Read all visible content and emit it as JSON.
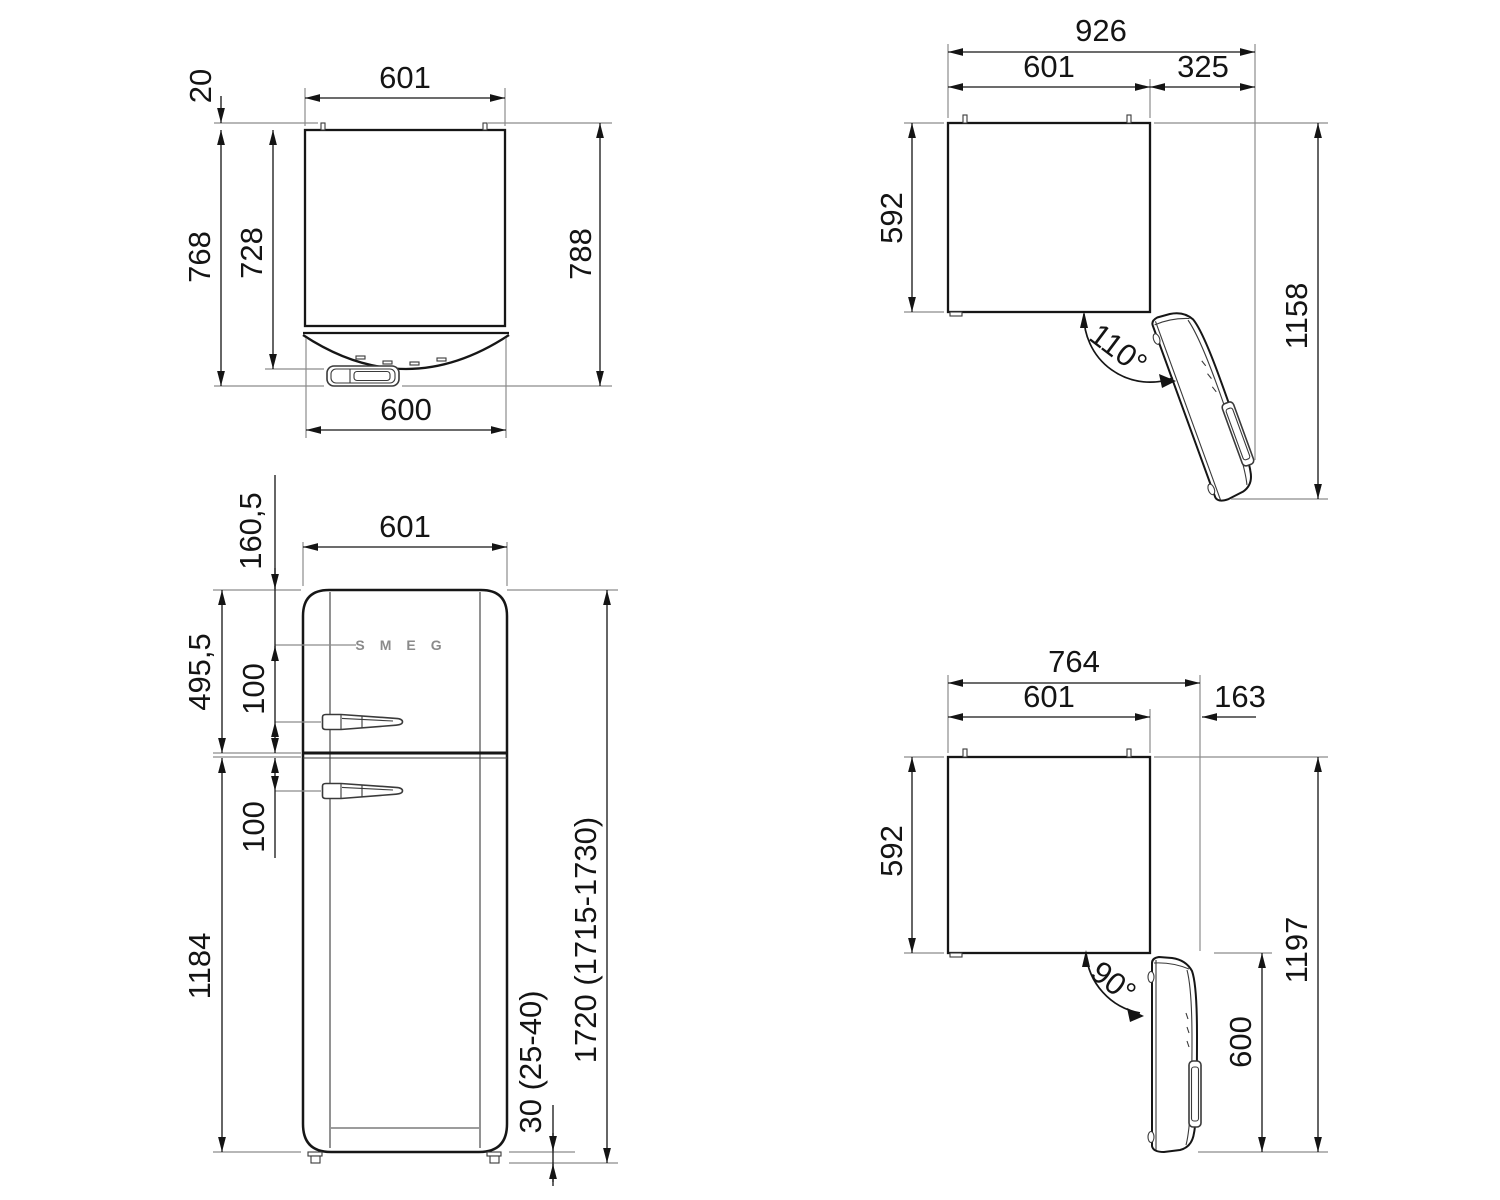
{
  "views": {
    "top_closed": {
      "dims": {
        "width": "601",
        "hinge_pin": "20",
        "depth_with_handle": "768",
        "depth_cabinet": "728",
        "depth_total": "788",
        "door_width": "600"
      }
    },
    "top_open_110": {
      "dims": {
        "total_width": "926",
        "width": "601",
        "door_projection": "325",
        "depth": "592",
        "total_depth": "1158",
        "angle": "110°"
      }
    },
    "front": {
      "logo": "SMEG",
      "dims": {
        "width": "601",
        "logo_offset": "160,5",
        "upper_door_height": "495,5",
        "upper_handle_offset": "100",
        "lower_handle_offset": "100",
        "lower_door_height": "1184",
        "total_height": "1720 (1715-1730)",
        "feet_height": "30 (25-40)"
      }
    },
    "top_open_90": {
      "dims": {
        "total_width": "764",
        "width": "601",
        "door_projection": "163",
        "depth": "592",
        "total_depth": "1197",
        "door_width": "600",
        "angle": "90°"
      }
    }
  }
}
